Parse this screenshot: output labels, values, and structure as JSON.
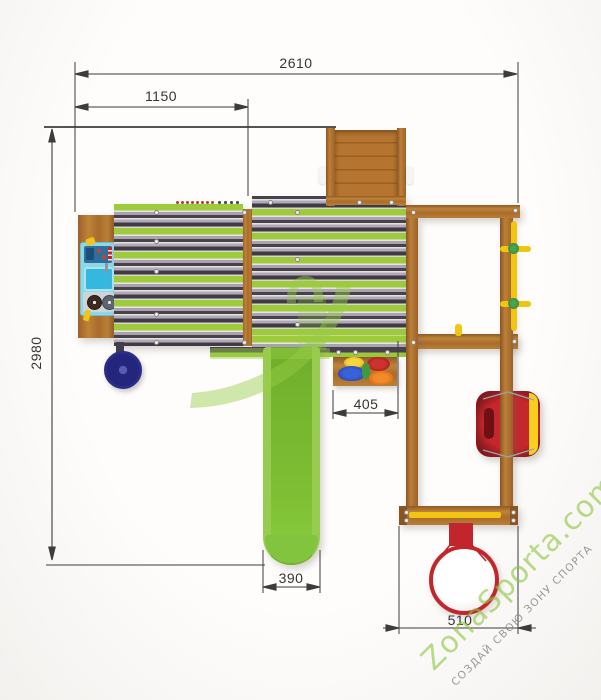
{
  "drawing": {
    "dimensions": {
      "overall_width": "2610",
      "left_section_width": "1150",
      "overall_depth": "2980",
      "toy_shelf_width": "405",
      "slide_width": "390",
      "swing_frame_width": "510"
    }
  },
  "watermark": {
    "brand": "ZonaSporta.com",
    "slogan": "СОЗДАЙ СВОЮ ЗОНУ СПОРТА"
  },
  "palette": {
    "brand_green": "#8dc63f",
    "stripe_green": "#9ecb3c",
    "stripe_purple": "#aba3b3",
    "stripe_dark": "#46424a",
    "wood": "#b0722f",
    "slide_green": "#7fbe35",
    "seat_red": "#b01f24",
    "hoop_red": "#c2262c",
    "pole_yellow": "#f2c512",
    "kitchen_blue": "#8ed7e6"
  }
}
